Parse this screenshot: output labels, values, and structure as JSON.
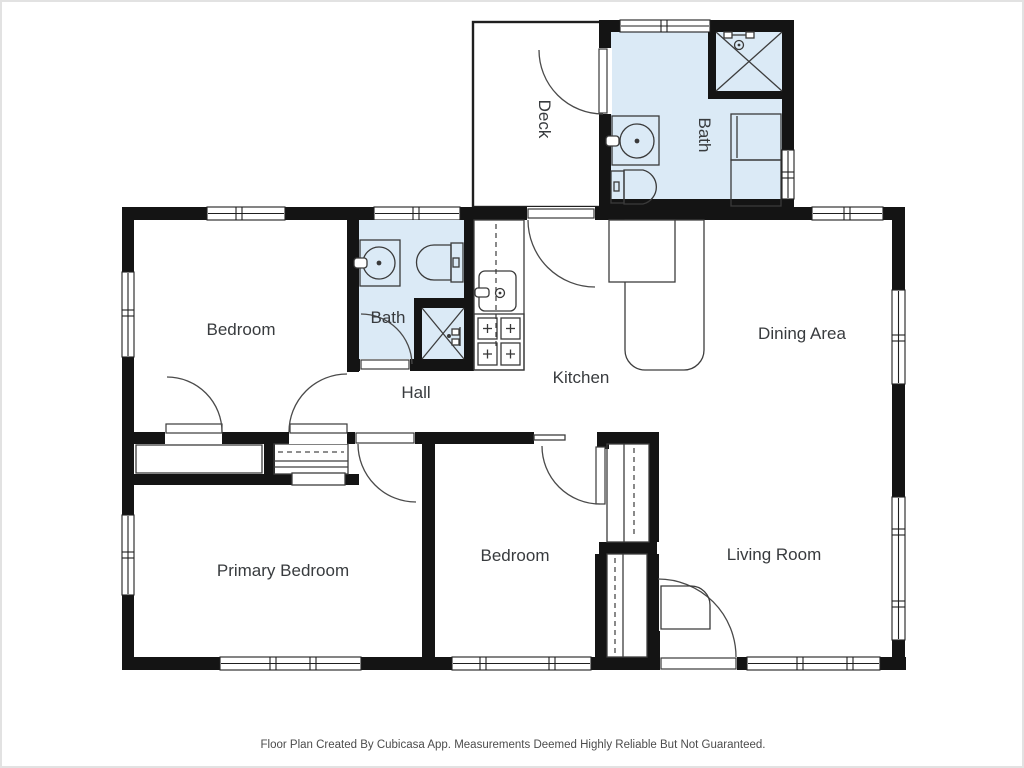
{
  "palette": {
    "wall": "#141414",
    "bath_fill": "#dbeaf6",
    "line_color": "#3d3d3d",
    "label_color": "#383b3e",
    "frame_color": "#e2e2e2"
  },
  "rooms": [
    {
      "id": "deck",
      "label": "Deck"
    },
    {
      "id": "bath-upper",
      "label": "Bath"
    },
    {
      "id": "bedroom",
      "label": "Bedroom"
    },
    {
      "id": "bath",
      "label": "Bath"
    },
    {
      "id": "hall",
      "label": "Hall"
    },
    {
      "id": "kitchen",
      "label": "Kitchen"
    },
    {
      "id": "dining-area",
      "label": "Dining Area"
    },
    {
      "id": "primary-bedroom",
      "label": "Primary Bedroom"
    },
    {
      "id": "bedroom-2",
      "label": "Bedroom"
    },
    {
      "id": "living-room",
      "label": "Living Room"
    }
  ],
  "footer": {
    "disclaimer": "Floor Plan Created By Cubicasa App. Measurements Deemed Highly Reliable But Not Guaranteed."
  }
}
